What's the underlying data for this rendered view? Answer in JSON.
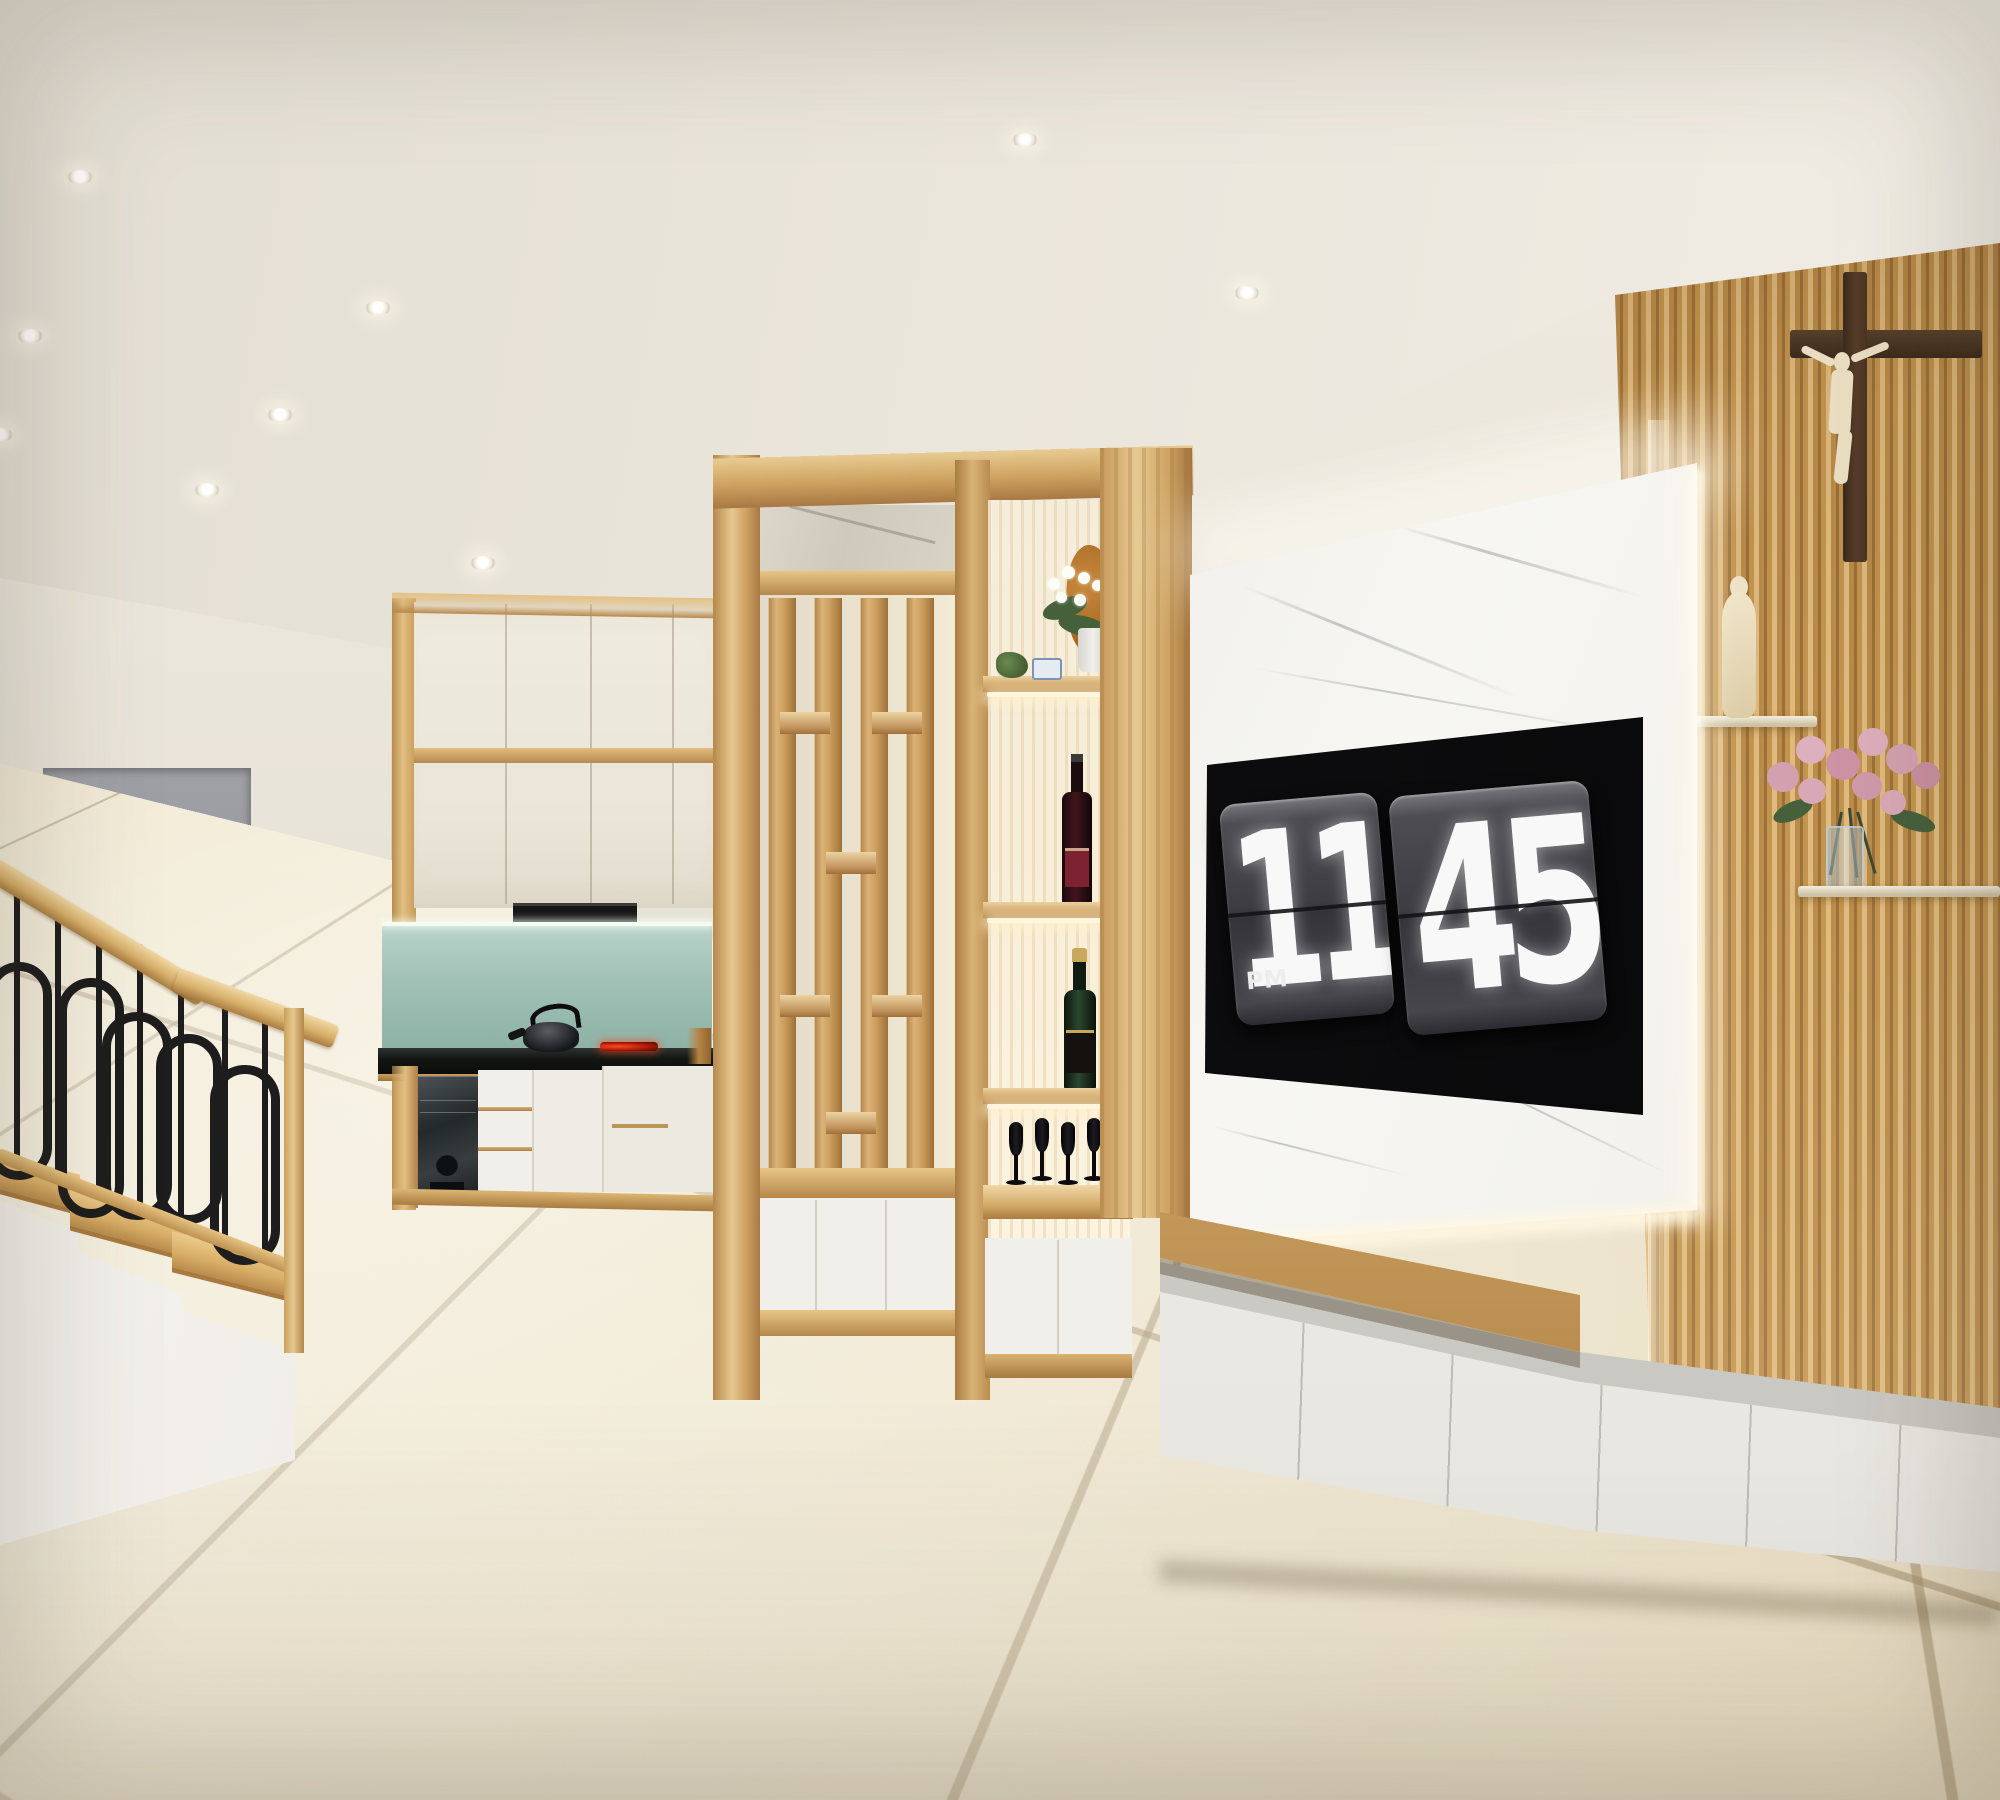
{
  "clock": {
    "hours": "11",
    "minutes": "45",
    "meridiem": "PM"
  },
  "colors": {
    "ceiling": "#ece7de",
    "wall": "#e9e4d9",
    "doorway_gray": "#9a9ba1",
    "wood_light": "#e8cd96",
    "wood_mid": "#d0a660",
    "wood_dark": "#a87843",
    "cream_cabinet": "#eee9dd",
    "white_cabinet": "#f1efe9",
    "backsplash_teal_top": "#b9d3ca",
    "backsplash_teal_bottom": "#8db2a5",
    "countertop_black": "#141614",
    "marble_white": "#f6f5f2",
    "tv_black": "#060606",
    "flip_card_gray": "#3e3e42",
    "digit_white": "#f8f8f8",
    "metal_black": "#1d1d1d",
    "ivory_statue": "#e9dcc0",
    "cross_brown": "#4a3424",
    "rose_pink": "#d5a5b5",
    "leaf_green": "#46603c",
    "led_warm": "#fff6dd",
    "floor_tile_beige": "#eadfc4"
  },
  "ceiling_lights": [
    [
      80,
      177
    ],
    [
      30,
      336
    ],
    [
      0,
      435
    ],
    [
      207,
      490
    ],
    [
      280,
      415
    ],
    [
      378,
      308
    ],
    [
      483,
      563
    ],
    [
      1025,
      140
    ],
    [
      1247,
      293
    ]
  ],
  "scene_objects": [
    "recessed-spotlights",
    "staircase",
    "wood-handrail",
    "metal-oval-balustrade",
    "gray-doorway",
    "corner-kitchen-cabinets",
    "glass-backsplash",
    "range-hood",
    "induction-hob",
    "kettle",
    "wood-partition-screen",
    "display-shelf-unit",
    "orchid-plant",
    "wood-carving",
    "red-wine-bottle",
    "champagne-bottle",
    "wine-glasses",
    "marble-tv-panel",
    "flip-clock-tv",
    "wood-bench-top",
    "media-base-cabinet",
    "slat-accent-wall",
    "crucifix",
    "ivory-statuette",
    "rose-bouquet",
    "glass-vase",
    "glass-wall-shelves",
    "beige-tile-floor"
  ]
}
